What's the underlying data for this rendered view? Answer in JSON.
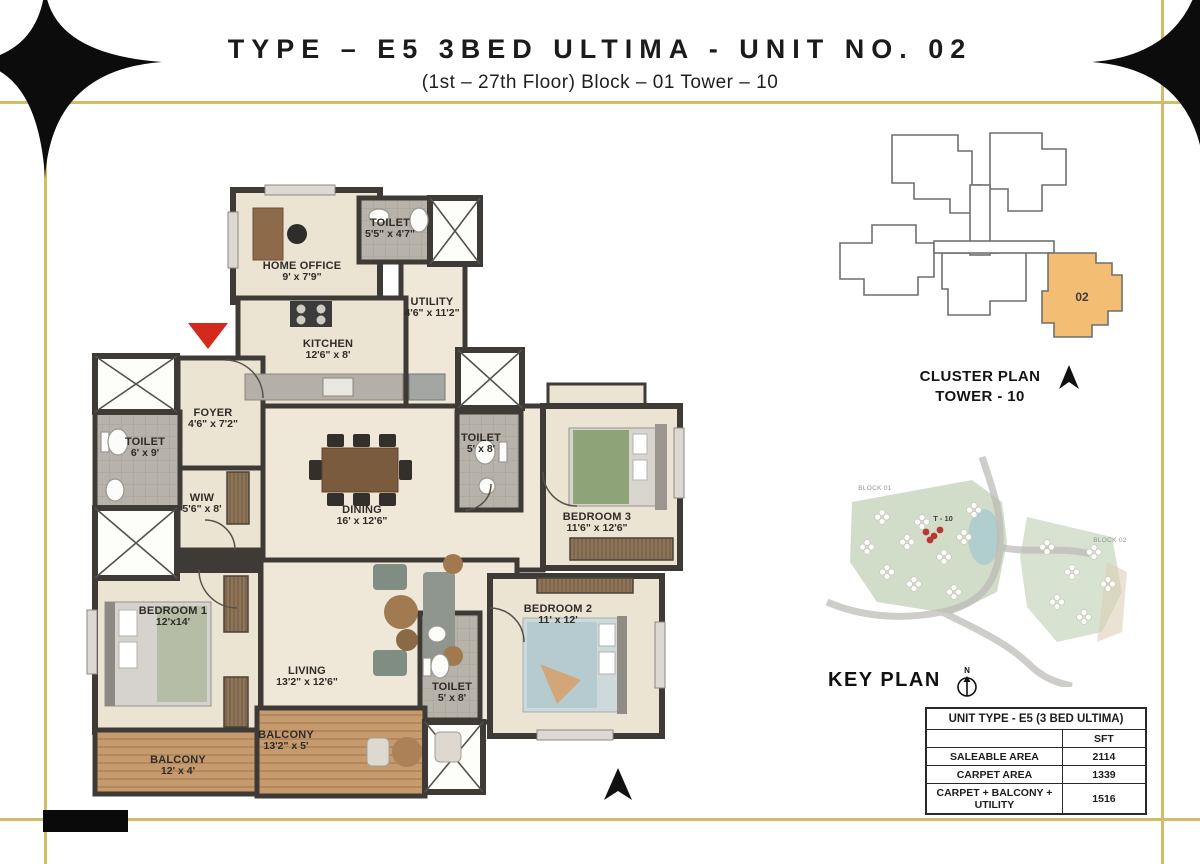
{
  "header": {
    "title": "TYPE – E5 3BED ULTIMA - UNIT NO. 02",
    "subtitle": "(1st – 27th Floor) Block – 01 Tower – 10"
  },
  "floorplan": {
    "rooms": [
      {
        "name": "HOME OFFICE",
        "dims": "9' x 7'9\""
      },
      {
        "name": "TOILET",
        "dims": "5'5\" x 4'7\""
      },
      {
        "name": "UTILITY",
        "dims": "4'6\" x 11'2\""
      },
      {
        "name": "KITCHEN",
        "dims": "12'6\" x 8'"
      },
      {
        "name": "FOYER",
        "dims": "4'6\" x 7'2\""
      },
      {
        "name": "TOILET",
        "dims": "6' x 9'"
      },
      {
        "name": "WIW",
        "dims": "5'6\" x 8'"
      },
      {
        "name": "DINING",
        "dims": "16' x 12'6\""
      },
      {
        "name": "TOILET",
        "dims": "5' x 8'"
      },
      {
        "name": "BEDROOM 3",
        "dims": "11'6\" x 12'6\""
      },
      {
        "name": "BEDROOM 1",
        "dims": "12'x14'"
      },
      {
        "name": "LIVING",
        "dims": "13'2\" x 12'6\""
      },
      {
        "name": "BEDROOM 2",
        "dims": "11' x 12'"
      },
      {
        "name": "TOILET",
        "dims": "5' x 8'"
      },
      {
        "name": "BALCONY",
        "dims": "12' x 4'"
      },
      {
        "name": "BALCONY",
        "dims": "13'2\" x 5'"
      }
    ]
  },
  "cluster_plan": {
    "unit_number": "02",
    "caption_line1": "CLUSTER PLAN",
    "caption_line2": "TOWER - 10"
  },
  "key_plan": {
    "caption": "KEY PLAN",
    "block1_label": "BLOCK 01",
    "block2_label": "BLOCK 02",
    "tower_label": "T - 10",
    "compass_label": "N"
  },
  "area_table": {
    "title": "UNIT TYPE - E5 (3 BED ULTIMA)",
    "unit_header": "SFT",
    "rows": [
      {
        "label": "SALEABLE AREA",
        "value": "2114"
      },
      {
        "label": "CARPET AREA",
        "value": "1339"
      },
      {
        "label": "CARPET + BALCONY + UTILITY",
        "value": "1516"
      }
    ]
  },
  "colors": {
    "gold_border": "#d2bd66",
    "wall": "#3e3b37",
    "room_fill": "#ece4d3",
    "toilet_fill": "#b7b2aa",
    "balcony_wood": "#c59a6c",
    "cluster_highlight": "#f3bd74",
    "entry_arrow_red": "#d3291e"
  }
}
